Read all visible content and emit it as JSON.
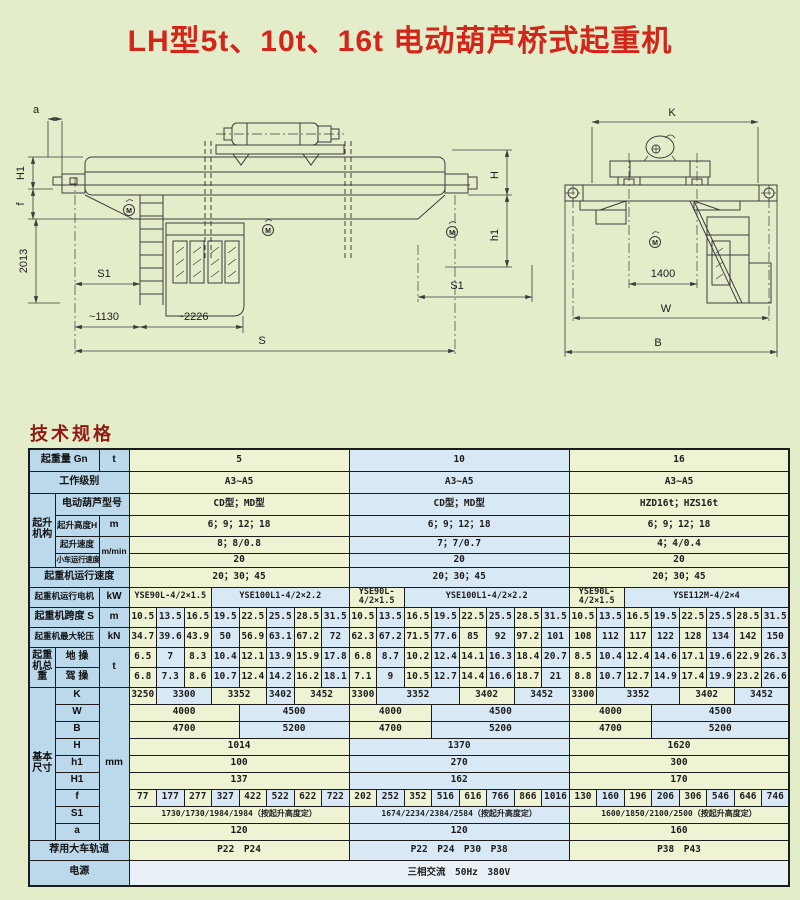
{
  "page": {
    "title": "LH型5t、10t、16t 电动葫芦桥式起重机",
    "section_heading": "技术规格"
  },
  "colors": {
    "page_bg": "#e4edc9",
    "title_red": "#d2261b",
    "heading_red": "#8f1a10",
    "cell_label": "#bcd9ec",
    "cell_green": "#eef3d3",
    "cell_blue": "#d8e9f5",
    "cell_power": "#e9f1f7",
    "border": "#1c1c1c"
  },
  "drawings": {
    "side_view": {
      "dims": {
        "a": "a",
        "H1": "H1",
        "f": "f",
        "v2013": "2013",
        "S1_left": "S1",
        "d1130": "~1130",
        "d2226": "~2226",
        "S": "S",
        "H": "H",
        "h1": "h1",
        "S1_right": "S1"
      },
      "motor_mark": "M"
    },
    "end_view": {
      "dims": {
        "K": "K",
        "d1400": "1400",
        "W": "W",
        "B": "B"
      },
      "motor_mark": "M"
    }
  },
  "table": {
    "layout": {
      "label_col_widths": [
        26,
        44,
        30
      ],
      "value_col_width": 27.5,
      "value_col_count": 24,
      "groups": [
        "5",
        "10",
        "16"
      ]
    },
    "rows": [
      {
        "h": 22,
        "cells": [
          {
            "t": "起重量 Gn",
            "c": 2,
            "k": "l"
          },
          {
            "t": "t",
            "k": "l"
          },
          {
            "t": "5",
            "c": 8,
            "k": "g"
          },
          {
            "t": "10",
            "c": 8,
            "k": "b"
          },
          {
            "t": "16",
            "c": 8,
            "k": "g"
          }
        ]
      },
      {
        "h": 22,
        "cells": [
          {
            "t": "工作级别",
            "c": 3,
            "k": "l"
          },
          {
            "t": "A3~A5",
            "c": 8,
            "k": "g"
          },
          {
            "t": "A3~A5",
            "c": 8,
            "k": "b"
          },
          {
            "t": "A3~A5",
            "c": 8,
            "k": "g"
          }
        ]
      },
      {
        "h": 22,
        "cells": [
          {
            "t": "起升机构",
            "r": 4,
            "k": "l"
          },
          {
            "t": "电动葫芦型号",
            "c": 2,
            "k": "l"
          },
          {
            "t": "CD型；MD型",
            "c": 8,
            "k": "g"
          },
          {
            "t": "CD型；MD型",
            "c": 8,
            "k": "b"
          },
          {
            "t": "HZD16t；HZS16t",
            "c": 8,
            "k": "g"
          }
        ]
      },
      {
        "h": 21,
        "cells": [
          {
            "t": "起升高度H",
            "k": "l",
            "s": 1
          },
          {
            "t": "m",
            "k": "l"
          },
          {
            "t": "6；9；12；18",
            "c": 8,
            "k": "g"
          },
          {
            "t": "6；9；12；18",
            "c": 8,
            "k": "b"
          },
          {
            "t": "6；9；12；18",
            "c": 8,
            "k": "g"
          }
        ]
      },
      {
        "h": 17,
        "cells": [
          {
            "t": "起升速度",
            "k": "l",
            "s": 1
          },
          {
            "t": "m/min",
            "r": 2,
            "k": "l",
            "s": 1
          },
          {
            "t": "8；8/0.8",
            "c": 8,
            "k": "g"
          },
          {
            "t": "7；7/0.7",
            "c": 8,
            "k": "b"
          },
          {
            "t": "4；4/0.4",
            "c": 8,
            "k": "g"
          }
        ]
      },
      {
        "h": 14,
        "cells": [
          {
            "t": "小车运行速度",
            "k": "l",
            "s": 3
          },
          {
            "t": "20",
            "c": 8,
            "k": "g"
          },
          {
            "t": "20",
            "c": 8,
            "k": "b"
          },
          {
            "t": "20",
            "c": 8,
            "k": "g"
          }
        ]
      },
      {
        "h": 20,
        "cells": [
          {
            "t": "起重机运行速度",
            "c": 3,
            "k": "l"
          },
          {
            "t": "20；30；45",
            "c": 8,
            "k": "g"
          },
          {
            "t": "20；30；45",
            "c": 8,
            "k": "b"
          },
          {
            "t": "20；30；45",
            "c": 8,
            "k": "g"
          }
        ]
      },
      {
        "h": 20,
        "cells": [
          {
            "t": "起重机运行电机",
            "c": 2,
            "k": "l",
            "s": 1
          },
          {
            "t": "kW",
            "k": "l"
          },
          {
            "t": "YSE90L-4/2×1.5",
            "c": 3,
            "k": "g",
            "s": 1
          },
          {
            "t": "YSE100L1-4/2×2.2",
            "c": 5,
            "k": "b",
            "s": 1
          },
          {
            "t": "YSE90L-4/2×1.5",
            "c": 2,
            "k": "g",
            "s": 1
          },
          {
            "t": "YSE100L1-4/2×2.2",
            "c": 6,
            "k": "b",
            "s": 1
          },
          {
            "t": "YSE90L-4/2×1.5",
            "c": 2,
            "k": "g",
            "s": 1
          },
          {
            "t": "YSE112M-4/2×4",
            "c": 6,
            "k": "b",
            "s": 1
          }
        ]
      },
      {
        "h": 20,
        "cells": [
          {
            "t": "起重机跨度 S",
            "c": 2,
            "k": "l"
          },
          {
            "t": "m",
            "k": "l"
          },
          {
            "seq": [
              "10.5",
              "13.5",
              "16.5",
              "19.5",
              "22.5",
              "25.5",
              "28.5",
              "31.5"
            ]
          },
          {
            "seq": [
              "10.5",
              "13.5",
              "16.5",
              "19.5",
              "22.5",
              "25.5",
              "28.5",
              "31.5"
            ]
          },
          {
            "seq": [
              "10.5",
              "13.5",
              "16.5",
              "19.5",
              "22.5",
              "25.5",
              "28.5",
              "31.5"
            ]
          }
        ]
      },
      {
        "h": 20,
        "cells": [
          {
            "t": "起重机最大轮压",
            "c": 2,
            "k": "l",
            "s": 1
          },
          {
            "t": "kN",
            "k": "l"
          },
          {
            "seq": [
              "34.7",
              "39.6",
              "43.9",
              "50",
              "56.9",
              "63.1",
              "67.2",
              "72"
            ]
          },
          {
            "seq": [
              "62.3",
              "67.2",
              "71.5",
              "77.6",
              "85",
              "92",
              "97.2",
              "101"
            ]
          },
          {
            "seq": [
              "108",
              "112",
              "117",
              "122",
              "128",
              "134",
              "142",
              "150"
            ]
          }
        ]
      },
      {
        "h": 20,
        "cells": [
          {
            "t": "起重机总重",
            "r": 2,
            "k": "l"
          },
          {
            "t": "地 操",
            "k": "l"
          },
          {
            "t": "t",
            "r": 2,
            "k": "l"
          },
          {
            "seq": [
              "6.5",
              "7",
              "8.3",
              "10.4",
              "12.1",
              "13.9",
              "15.9",
              "17.8"
            ]
          },
          {
            "seq": [
              "6.8",
              "8.7",
              "10.2",
              "12.4",
              "14.1",
              "16.3",
              "18.4",
              "20.7"
            ]
          },
          {
            "seq": [
              "8.5",
              "10.4",
              "12.4",
              "14.6",
              "17.1",
              "19.6",
              "22.9",
              "26.3"
            ]
          }
        ]
      },
      {
        "h": 20,
        "cells": [
          {
            "t": "驾 操",
            "k": "l"
          },
          {
            "seq": [
              "6.8",
              "7.3",
              "8.6",
              "10.7",
              "12.4",
              "14.2",
              "16.2",
              "18.1"
            ]
          },
          {
            "seq": [
              "7.1",
              "9",
              "10.5",
              "12.7",
              "14.4",
              "16.6",
              "18.7",
              "21"
            ]
          },
          {
            "seq": [
              "8.8",
              "10.7",
              "12.7",
              "14.9",
              "17.4",
              "19.9",
              "23.2",
              "26.6"
            ]
          }
        ]
      },
      {
        "h": 17,
        "cells": [
          {
            "t": "基本尺寸",
            "r": 9,
            "k": "l"
          },
          {
            "t": "K",
            "k": "l"
          },
          {
            "t": "mm",
            "r": 9,
            "k": "l"
          },
          {
            "t": "3250",
            "k": "g"
          },
          {
            "t": "3300",
            "c": 2,
            "k": "b"
          },
          {
            "t": "3352",
            "c": 2,
            "k": "g"
          },
          {
            "t": "3402",
            "k": "b"
          },
          {
            "t": "3452",
            "c": 2,
            "k": "g"
          },
          {
            "t": "3300",
            "k": "g"
          },
          {
            "t": "3352",
            "c": 3,
            "k": "b"
          },
          {
            "t": "3402",
            "c": 2,
            "k": "g"
          },
          {
            "t": "3452",
            "c": 2,
            "k": "b"
          },
          {
            "t": "3300",
            "k": "g"
          },
          {
            "t": "3352",
            "c": 3,
            "k": "b"
          },
          {
            "t": "3402",
            "c": 2,
            "k": "g"
          },
          {
            "t": "3452",
            "c": 2,
            "k": "b"
          }
        ]
      },
      {
        "h": 17,
        "cells": [
          {
            "t": "W",
            "k": "l"
          },
          {
            "t": "4000",
            "c": 4,
            "k": "g"
          },
          {
            "t": "4500",
            "c": 4,
            "k": "b"
          },
          {
            "t": "4000",
            "c": 3,
            "k": "g"
          },
          {
            "t": "4500",
            "c": 5,
            "k": "b"
          },
          {
            "t": "4000",
            "c": 3,
            "k": "g"
          },
          {
            "t": "4500",
            "c": 5,
            "k": "b"
          }
        ]
      },
      {
        "h": 17,
        "cells": [
          {
            "t": "B",
            "k": "l"
          },
          {
            "t": "4700",
            "c": 4,
            "k": "g"
          },
          {
            "t": "5200",
            "c": 4,
            "k": "b"
          },
          {
            "t": "4700",
            "c": 3,
            "k": "g"
          },
          {
            "t": "5200",
            "c": 5,
            "k": "b"
          },
          {
            "t": "4700",
            "c": 3,
            "k": "g"
          },
          {
            "t": "5200",
            "c": 5,
            "k": "b"
          }
        ]
      },
      {
        "h": 17,
        "cells": [
          {
            "t": "H",
            "k": "l"
          },
          {
            "t": "1014",
            "c": 8,
            "k": "g"
          },
          {
            "t": "1370",
            "c": 8,
            "k": "b"
          },
          {
            "t": "1620",
            "c": 8,
            "k": "g"
          }
        ]
      },
      {
        "h": 17,
        "cells": [
          {
            "t": "h1",
            "k": "l"
          },
          {
            "t": "100",
            "c": 8,
            "k": "g"
          },
          {
            "t": "270",
            "c": 8,
            "k": "b"
          },
          {
            "t": "300",
            "c": 8,
            "k": "g"
          }
        ]
      },
      {
        "h": 17,
        "cells": [
          {
            "t": "H1",
            "k": "l"
          },
          {
            "t": "137",
            "c": 8,
            "k": "g"
          },
          {
            "t": "162",
            "c": 8,
            "k": "b"
          },
          {
            "t": "170",
            "c": 8,
            "k": "g"
          }
        ]
      },
      {
        "h": 17,
        "cells": [
          {
            "t": "f",
            "k": "l"
          },
          {
            "seq": [
              "77",
              "177",
              "277",
              "327",
              "422",
              "522",
              "622",
              "722"
            ]
          },
          {
            "seq": [
              "202",
              "252",
              "352",
              "516",
              "616",
              "766",
              "866",
              "1016"
            ]
          },
          {
            "seq": [
              "130",
              "160",
              "196",
              "206",
              "306",
              "546",
              "646",
              "746"
            ]
          }
        ]
      },
      {
        "h": 17,
        "cells": [
          {
            "t": "S1",
            "k": "l"
          },
          {
            "t": "1730/1730/1984/1984（按起升高度定）",
            "c": 8,
            "k": "g",
            "s": 2
          },
          {
            "t": "1674/2234/2384/2584（按起升高度定）",
            "c": 8,
            "k": "b",
            "s": 2
          },
          {
            "t": "1600/1850/2100/2500（按起升高度定）",
            "c": 8,
            "k": "g",
            "s": 2
          }
        ]
      },
      {
        "h": 17,
        "cells": [
          {
            "t": "a",
            "k": "l"
          },
          {
            "t": "120",
            "c": 8,
            "k": "g"
          },
          {
            "t": "120",
            "c": 8,
            "k": "b"
          },
          {
            "t": "160",
            "c": 8,
            "k": "g"
          }
        ]
      },
      {
        "h": 20,
        "cells": [
          {
            "t": "荐用大车轨道",
            "c": 3,
            "k": "l"
          },
          {
            "t": "P22　P24",
            "c": 8,
            "k": "g"
          },
          {
            "t": "P22　P24　P30　P38",
            "c": 8,
            "k": "b"
          },
          {
            "t": "P38　P43",
            "c": 8,
            "k": "g"
          }
        ]
      },
      {
        "h": 26,
        "cells": [
          {
            "t": "电源",
            "c": 3,
            "k": "l"
          },
          {
            "t": "三相交流　50Hz　380V",
            "c": 24,
            "k": "w"
          }
        ]
      }
    ]
  }
}
